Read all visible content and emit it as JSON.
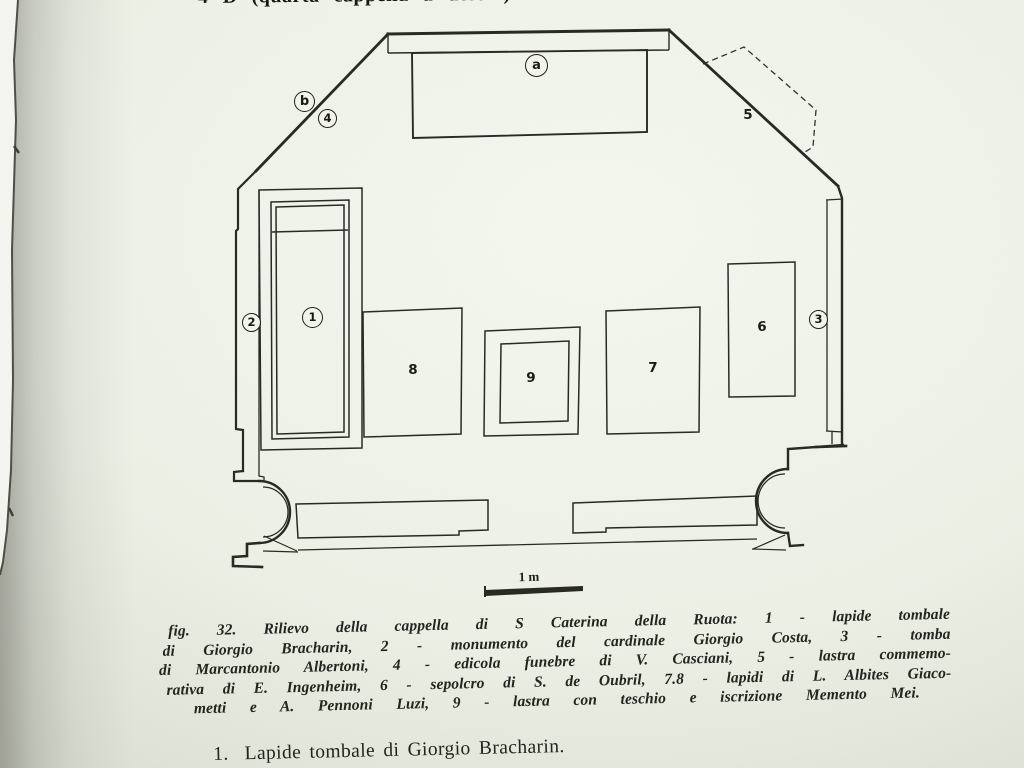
{
  "page": {
    "header_cropped_line": "4 D (quarta cappella a destra) dedicata a S. Caterina",
    "footer_item_number": "1.",
    "footer_item_text": "Lapide tombale di Giorgio Bracharin."
  },
  "plan": {
    "markers": {
      "a": "a",
      "b": "b",
      "n1": "1",
      "n2": "2",
      "n3": "3",
      "n4": "4",
      "n5": "5",
      "n6": "6",
      "n7": "7",
      "n8": "8",
      "n9": "9"
    },
    "scale_label": "1 m"
  },
  "caption": {
    "fig_label": "fig. 32.",
    "line1_rest": "Rilievo della cappella di S Caterina della Ruota: 1 - lapide tombale",
    "line2": "di Giorgio Bracharin, 2 - monumento del cardinale Giorgio Costa, 3 - tomba",
    "line3": "di Marcantonio Albertoni, 4 - edicola funebre di V. Casciani, 5 - lastra commemo-",
    "line4": "rativa di E. Ingenheim, 6 - sepolcro di S. de Oubril, 7.8 - lapidi di L. Albites Giaco-",
    "line5": "metti e A. Pennoni Luzi, 9 - lastra con teschio e iscrizione Memento Mei."
  }
}
